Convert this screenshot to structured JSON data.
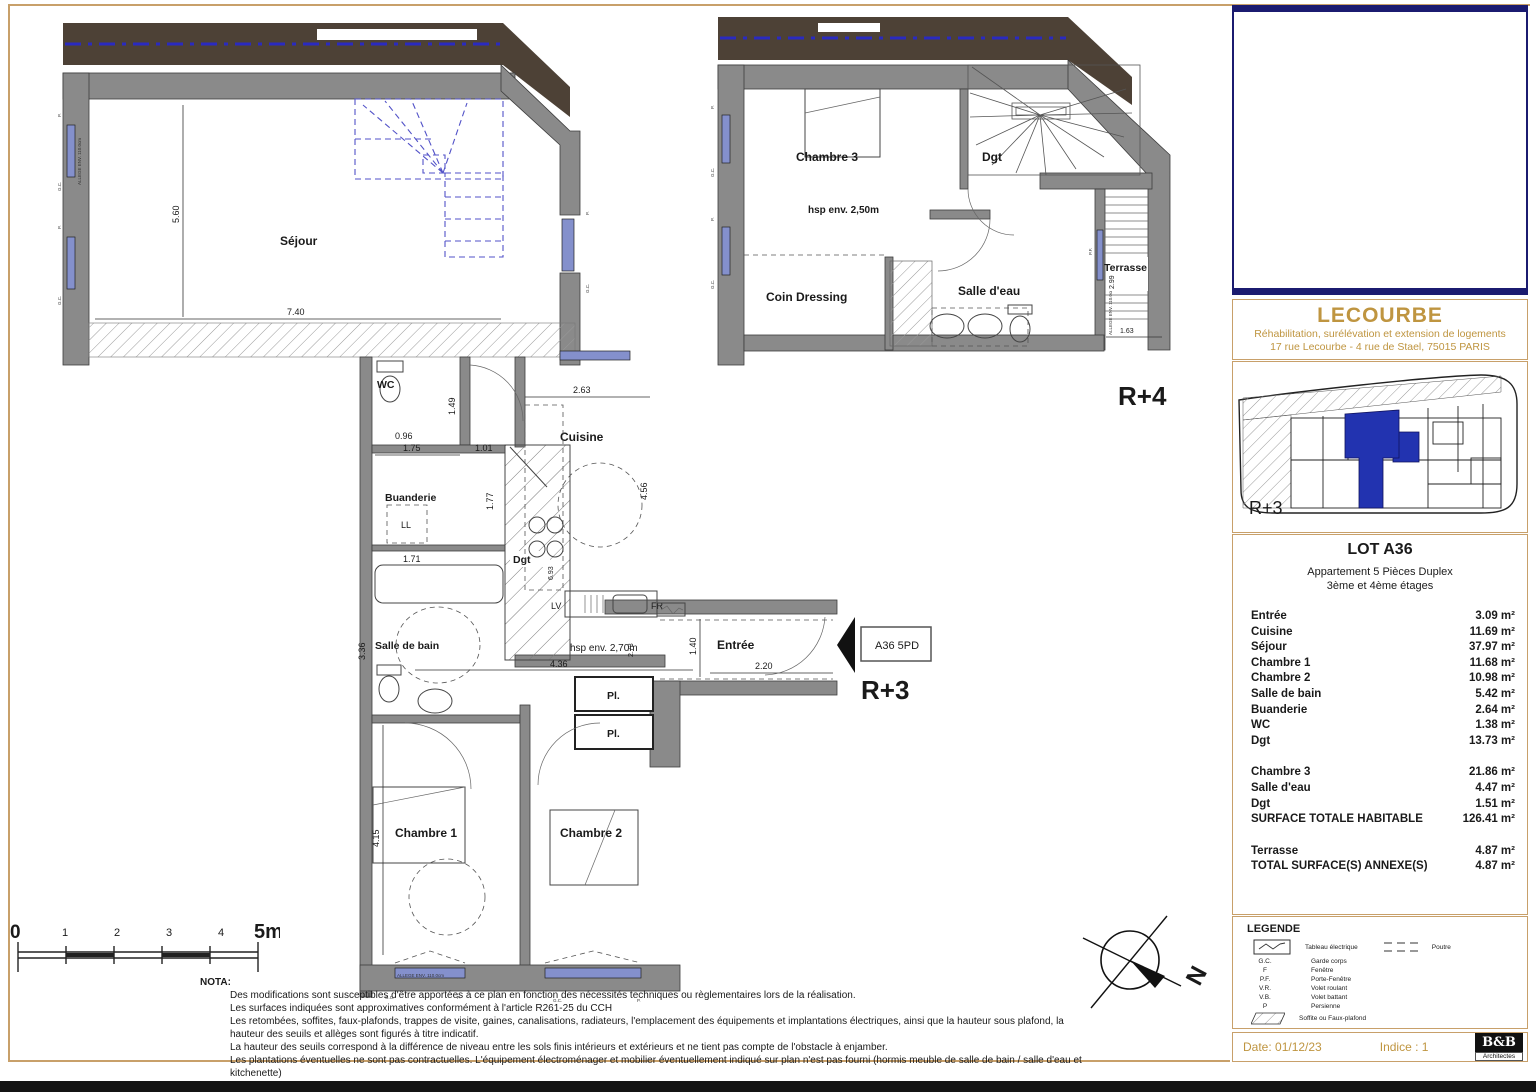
{
  "plans": {
    "r3": {
      "floor_label": "R+3",
      "unit_tag": "A36 5PD",
      "hsp": "hsp env. 2,70m",
      "rooms": {
        "sejour": "Séjour",
        "wc": "WC",
        "buanderie": "Buanderie",
        "dgt": "Dgt",
        "cuisine": "Cuisine",
        "sdb": "Salle de bain",
        "entree": "Entrée",
        "pl": "Pl.",
        "ch1": "Chambre 1",
        "ch2": "Chambre 2"
      },
      "dims": {
        "sejour_w": "7.40",
        "sejour_h": "5.60",
        "wc_h": "1.49",
        "wc_w": "0.96",
        "bu_w": "1.75",
        "bu_d": "1.01",
        "bu_h": "1.77",
        "tub": "1.71",
        "sdb_h": "3.36",
        "cui_w": "2.63",
        "cui_h": "4.56",
        "cui_d": "2.73",
        "hall": "4.36",
        "ent_h": "1.40",
        "ent_w": "2.20",
        "ch1_h": "4.15",
        "dgt_h": "6.93"
      },
      "appliances": {
        "ll": "LL",
        "lv": "LV",
        "fr": "FR"
      }
    },
    "r4": {
      "floor_label": "R+4",
      "hsp": "hsp env. 2,50m",
      "rooms": {
        "ch3": "Chambre 3",
        "dgt": "Dgt",
        "dressing": "Coin Dressing",
        "sde": "Salle d'eau",
        "terrasse": "Terrasse"
      },
      "dims": {
        "terrasse_h": "2.99",
        "terrasse_w": "1.63"
      }
    },
    "window_labels": {
      "p": "P.",
      "gc": "G.C.",
      "pf": "P.F.",
      "allege": "ALLEGE ENV. 110.0cm"
    }
  },
  "scalebar": {
    "t0": "0",
    "t1": "1",
    "t2": "2",
    "t3": "3",
    "t4": "4",
    "t5": "5m"
  },
  "north_label": "N",
  "nota": {
    "title": "NOTA:",
    "lines": [
      "Des modifications sont susceptibles d'être apportées à ce plan en fonction des nécessités techniques ou règlementaires lors de la réalisation.",
      "Les surfaces indiquées sont approximatives conformément à l'article R261-25 du CCH",
      "Les retombées, soffites, faux-plafonds, trappes de visite, gaines, canalisations, radiateurs, l'emplacement des équipements et implantations électriques, ainsi que la hauteur sous plafond, la hauteur des seuils et allèges sont figurés à titre indicatif.",
      "La hauteur des seuils correspond à la différence de niveau entre les sols finis intérieurs et extérieurs et ne tient pas compte de l'obstacle à enjamber.",
      "Les plantations éventuelles ne sont pas contractuelles. L'équipement électroménager et mobilier éventuellement indiqué sur plan n'est pas fourni (hormis meuble de salle de bain / salle d'eau et kitchenette)"
    ]
  },
  "titleblock": {
    "project": "LECOURBE",
    "subtitle1": "Réhabilitation, surélévation et extension de logements",
    "subtitle2": "17 rue Lecourbe  - 4 rue de Stael, 75015 PARIS",
    "keyplan_level": "R+3",
    "lot": {
      "title": "LOT A36",
      "type": "Appartement 5 Pièces Duplex",
      "floors": "3ème et 4ème étages",
      "group1": [
        {
          "label": "Entrée",
          "value": "3.09 m²"
        },
        {
          "label": "Cuisine",
          "value": "11.69 m²"
        },
        {
          "label": "Séjour",
          "value": "37.97 m²"
        },
        {
          "label": "Chambre 1",
          "value": "11.68 m²"
        },
        {
          "label": "Chambre 2",
          "value": "10.98 m²"
        },
        {
          "label": "Salle de bain",
          "value": "5.42 m²"
        },
        {
          "label": "Buanderie",
          "value": "2.64 m²"
        },
        {
          "label": "WC",
          "value": "1.38 m²"
        },
        {
          "label": "Dgt",
          "value": "13.73 m²"
        }
      ],
      "group2": [
        {
          "label": "Chambre 3",
          "value": "21.86 m²"
        },
        {
          "label": "Salle d'eau",
          "value": "4.47 m²"
        },
        {
          "label": "Dgt",
          "value": "1.51 m²"
        },
        {
          "label": "SURFACE TOTALE HABITABLE",
          "value": "126.41 m²"
        }
      ],
      "group3": [
        {
          "label": "Terrasse",
          "value": "4.87 m²"
        },
        {
          "label": "TOTAL SURFACE(S) ANNEXE(S)",
          "value": "4.87 m²"
        }
      ]
    },
    "legend": {
      "title": "LEGENDE",
      "sym_tableau": "Tableau électrique",
      "sym_poutre": "Poutre",
      "abbrs": [
        {
          "abbr": "G.C.",
          "label": "Garde corps"
        },
        {
          "abbr": "F",
          "label": "Fenêtre"
        },
        {
          "abbr": "P.F.",
          "label": "Porte-Fenêtre"
        },
        {
          "abbr": "V.R.",
          "label": "Volet roulant"
        },
        {
          "abbr": "V.B.",
          "label": "Volet battant"
        },
        {
          "abbr": "P",
          "label": "Persienne"
        }
      ],
      "sym_soffite": "Soffite ou Faux-plafond"
    },
    "footer": {
      "date": "Date:  01/12/23",
      "indice": "Indice : 1",
      "firm": "B&B",
      "firm_sub": "Architectes"
    }
  }
}
